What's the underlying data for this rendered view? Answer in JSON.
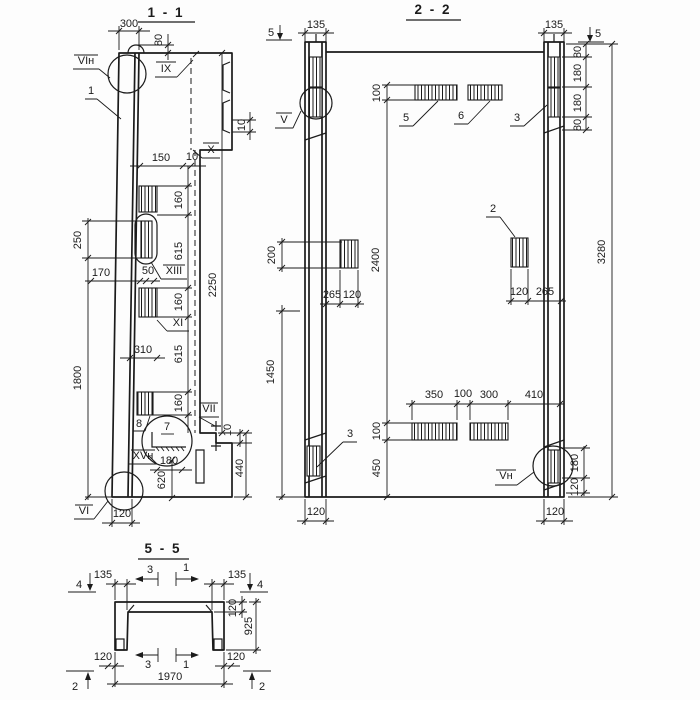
{
  "colors": {
    "ink": "#1b1b1b",
    "paper": "#fdfdfd"
  },
  "s11": {
    "title": "1 - 1",
    "dims": {
      "d300": "300",
      "d80": "80",
      "d10_notch": "10",
      "d150": "150",
      "d10_gap": "10",
      "d160a": "160",
      "d615a": "615",
      "d160b": "160",
      "d615b": "615",
      "d160c": "160",
      "d2250": "2250",
      "d250": "250",
      "d170": "170",
      "d50": "50",
      "d310": "310",
      "d1800": "1800",
      "d180": "180",
      "d620": "620",
      "d440": "440",
      "d10_step": "10",
      "d120": "120"
    },
    "labels": {
      "vi_top": "VIн",
      "pos1": "1",
      "ix": "IX",
      "x": "X",
      "xiii": "XIII",
      "xi": "XI",
      "pos8": "8",
      "pos7": "7",
      "vii": "VII",
      "xv": "XVн",
      "vi_bottom": "VI"
    }
  },
  "s22": {
    "title": "2 - 2",
    "dims": {
      "d135l": "135",
      "d135r": "135",
      "d80a": "80",
      "d180a": "180",
      "d180b": "180",
      "d80b": "80",
      "d100top": "100",
      "d2400": "2400",
      "d200": "200",
      "d1450": "1450",
      "d265l": "265",
      "d120l": "120",
      "d120r": "120",
      "d265r": "265",
      "d350": "350",
      "d100b": "100",
      "d300": "300",
      "d410": "410",
      "d100v": "100",
      "d450": "450",
      "d180c": "180",
      "d120c": "120",
      "d120bl": "120",
      "d120br": "120",
      "d3280": "3280"
    },
    "labels": {
      "cut5l": "5",
      "cut5r": "5",
      "v": "V",
      "vn": "Vн",
      "pos2": "2",
      "pos3l": "3",
      "pos3r": "3",
      "pos5": "5",
      "pos6": "6"
    }
  },
  "s55": {
    "title": "5 - 5",
    "dims": {
      "d135l": "135",
      "d135r": "135",
      "d120t": "120",
      "d925": "925",
      "d120bl": "120",
      "d120br": "120",
      "d1970": "1970"
    },
    "labels": {
      "cut4l": "4",
      "cut4r": "4",
      "cut2l": "2",
      "cut2r": "2",
      "a3top": "3",
      "a1top": "1",
      "a3bot": "3",
      "a1bot": "1"
    }
  }
}
